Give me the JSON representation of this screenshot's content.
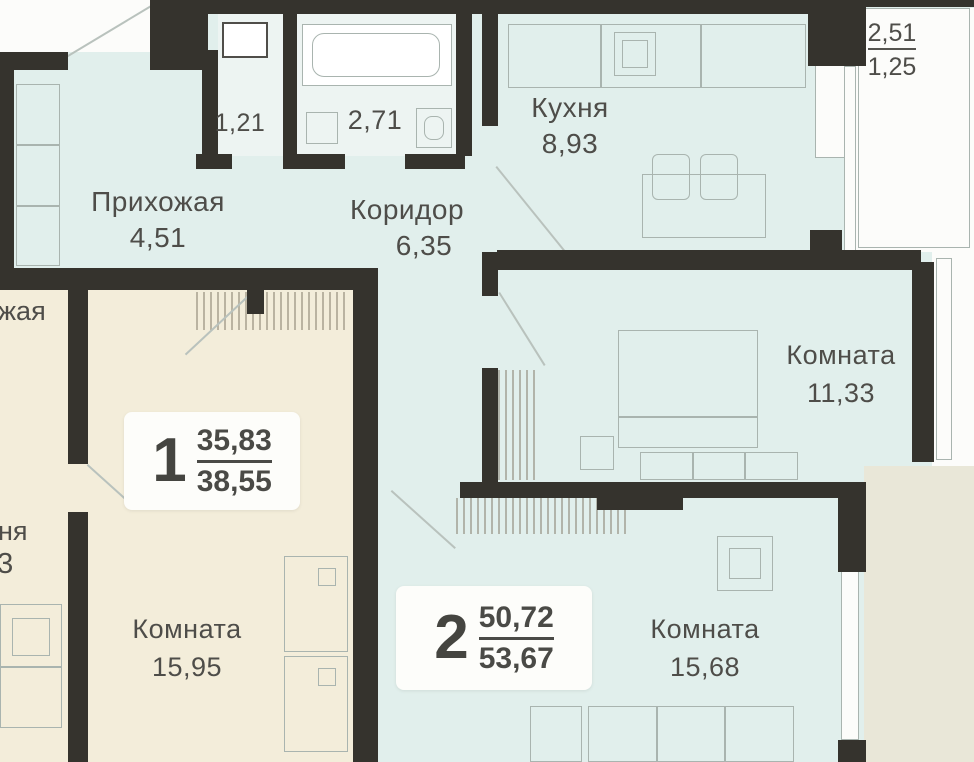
{
  "plan": {
    "apartments": [
      {
        "number": "1",
        "area_living": "35,83",
        "area_total": "38,55"
      },
      {
        "number": "2",
        "area_living": "50,72",
        "area_total": "53,67"
      }
    ],
    "rooms": {
      "hallway": {
        "name": "Прихожая",
        "area": "4,51"
      },
      "corridor": {
        "name": "Коридор",
        "area": "6,35"
      },
      "kitchen": {
        "name": "Кухня",
        "area": "8,93"
      },
      "wc": {
        "area": "1,21"
      },
      "bathroom": {
        "area": "2,71"
      },
      "balcony": {
        "area_upper": "2,51",
        "area_lower": "1,25"
      },
      "room_right": {
        "name": "Комната",
        "area": "11,33"
      },
      "room_apt1": {
        "name": "Комната",
        "area": "15,95"
      },
      "room_apt2": {
        "name": "Комната",
        "area": "15,68"
      }
    },
    "partial_labels": {
      "top_text": "жая",
      "top_number": "0",
      "bottom_text": "ня",
      "bottom_number": "23"
    },
    "colors": {
      "wall": "#35332d",
      "apartment1_fill": "#f3edda",
      "apartment2_fill": "#e1efec",
      "bath_fill": "#edf4f2",
      "outside": "#e9e7d8",
      "card": "#fdfdfa",
      "text": "#4e4d49",
      "furniture_line": "#a9b4af"
    }
  }
}
